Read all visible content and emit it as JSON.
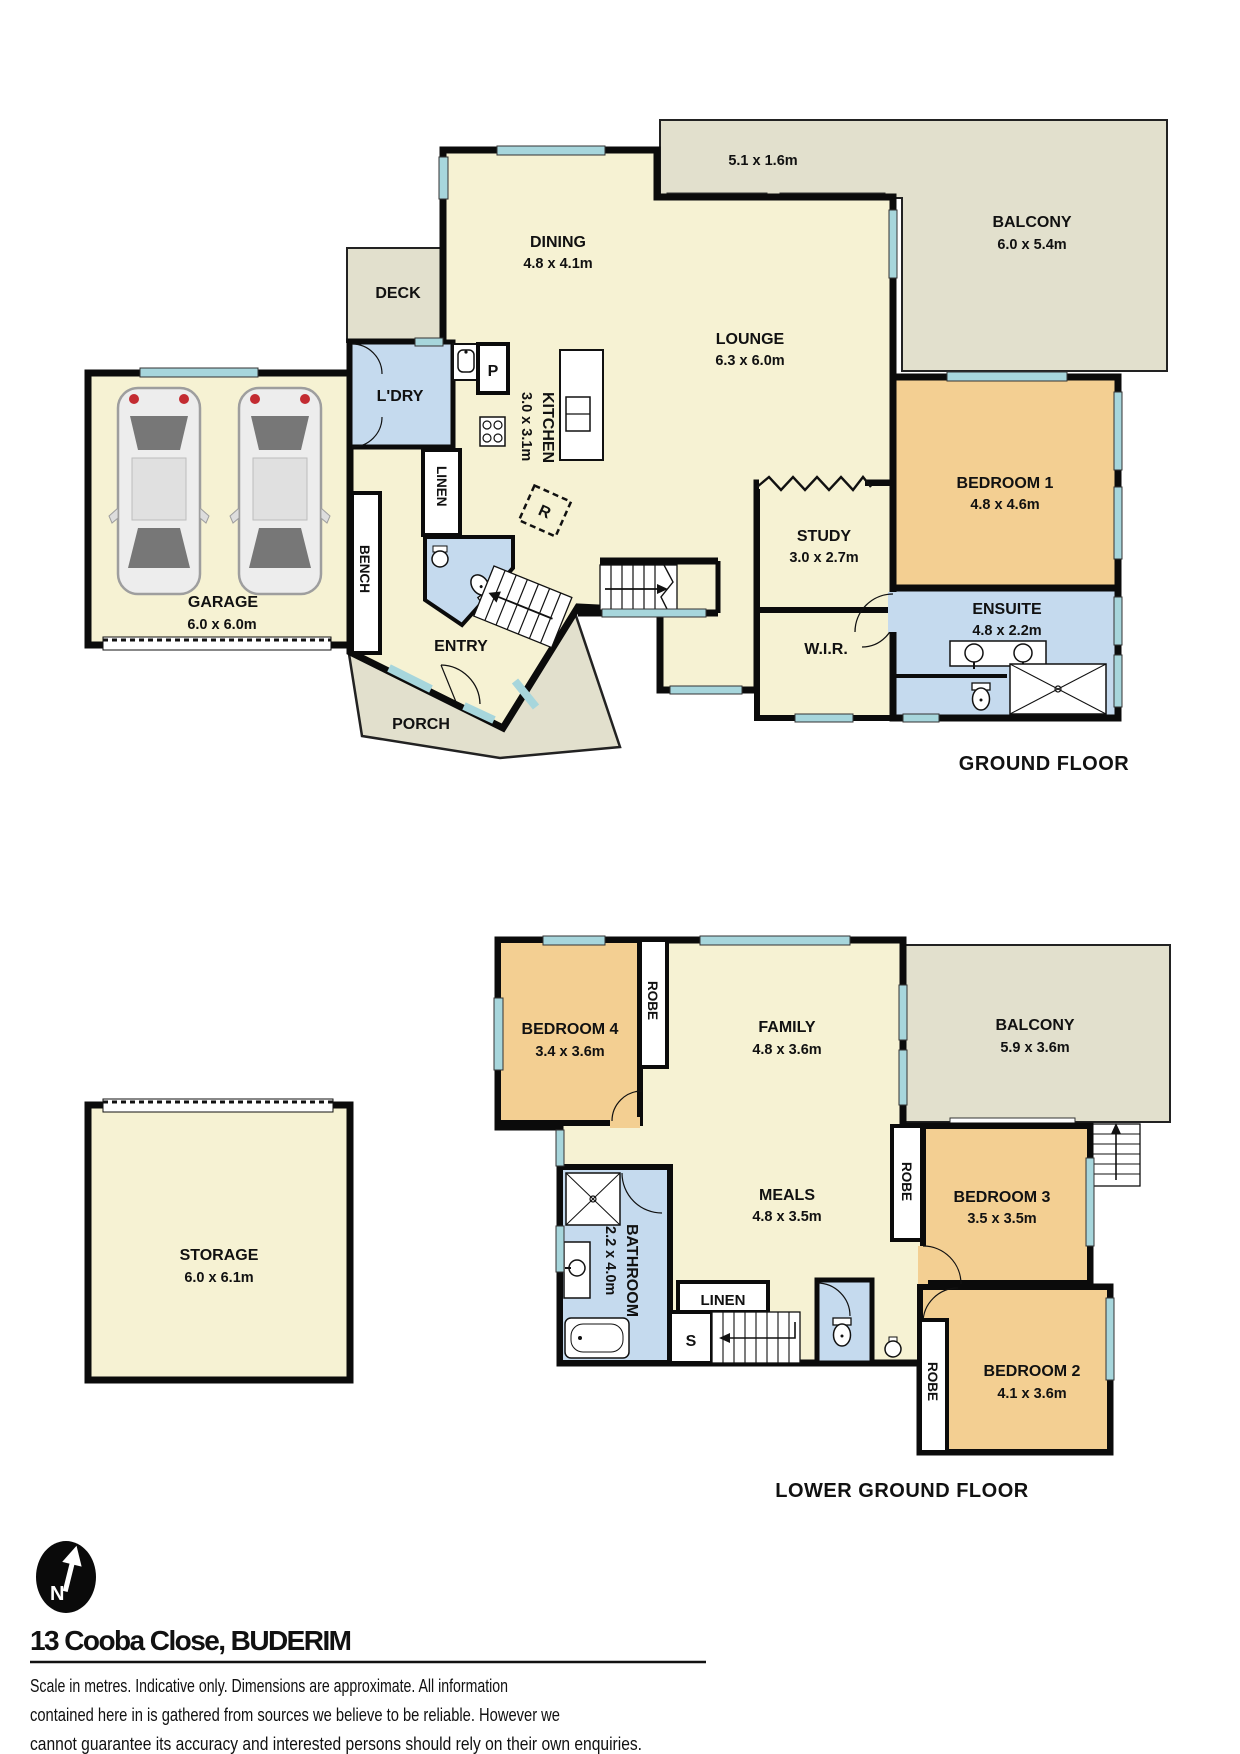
{
  "colors": {
    "wall": "#0b0b0b",
    "cream": "#F6F2D3",
    "bedroom": "#F3CF92",
    "wet": "#C5DAEE",
    "outdoor": "#E2E0CD",
    "window": "#A7D6DC",
    "white": "#FFFFFF"
  },
  "gf": {
    "floor_label": "GROUND FLOOR",
    "dining": {
      "name": "DINING",
      "dims": "4.8 x 4.1m"
    },
    "lounge": {
      "name": "LOUNGE",
      "dims": "6.3 x 6.0m"
    },
    "balcony": {
      "name": "BALCONY",
      "dims": "6.0 x 5.4m"
    },
    "balcony_strip_dims": "5.1 x 1.6m",
    "deck": "DECK",
    "ldry": "L'DRY",
    "pantry": "P",
    "fridge": "R",
    "kitchen": {
      "name": "KITCHEN",
      "dims": "3.0 x 3.1m"
    },
    "linen": "LINEN",
    "bench": "BENCH",
    "garage": {
      "name": "GARAGE",
      "dims": "6.0 x 6.0m"
    },
    "entry": "ENTRY",
    "porch": "PORCH",
    "study": {
      "name": "STUDY",
      "dims": "3.0 x 2.7m"
    },
    "wir": "W.I.R.",
    "bed1": {
      "name": "BEDROOM 1",
      "dims": "4.8 x 4.6m"
    },
    "ensuite": {
      "name": "ENSUITE",
      "dims": "4.8 x 2.2m"
    }
  },
  "lgf": {
    "floor_label": "LOWER GROUND FLOOR",
    "bed4": {
      "name": "BEDROOM 4",
      "dims": "3.4 x 3.6m"
    },
    "robe4": "ROBE",
    "family": {
      "name": "FAMILY",
      "dims": "4.8 x 3.6m"
    },
    "balcony": {
      "name": "BALCONY",
      "dims": "5.9 x 3.6m"
    },
    "meals": {
      "name": "MEALS",
      "dims": "4.8 x 3.5m"
    },
    "robe3": "ROBE",
    "bed3": {
      "name": "BEDROOM 3",
      "dims": "3.5 x 3.5m"
    },
    "bathroom": {
      "name": "BATHROOM",
      "dims": "2.2 x 4.0m"
    },
    "linen": "LINEN",
    "stair_s": "S",
    "bed2": {
      "name": "BEDROOM 2",
      "dims": "4.1 x 3.6m"
    },
    "robe2": "ROBE",
    "storage": {
      "name": "STORAGE",
      "dims": "6.0 x 6.1m"
    }
  },
  "footer": {
    "north_label": "N",
    "address": "13 Cooba Close, BUDERIM",
    "disclaimer_lines": [
      "Scale in metres. Indicative only. Dimensions are approximate. All information",
      "contained here in is gathered from sources we believe to be reliable. However we",
      "cannot guarantee its accuracy and interested persons should rely on their own enquiries."
    ]
  }
}
